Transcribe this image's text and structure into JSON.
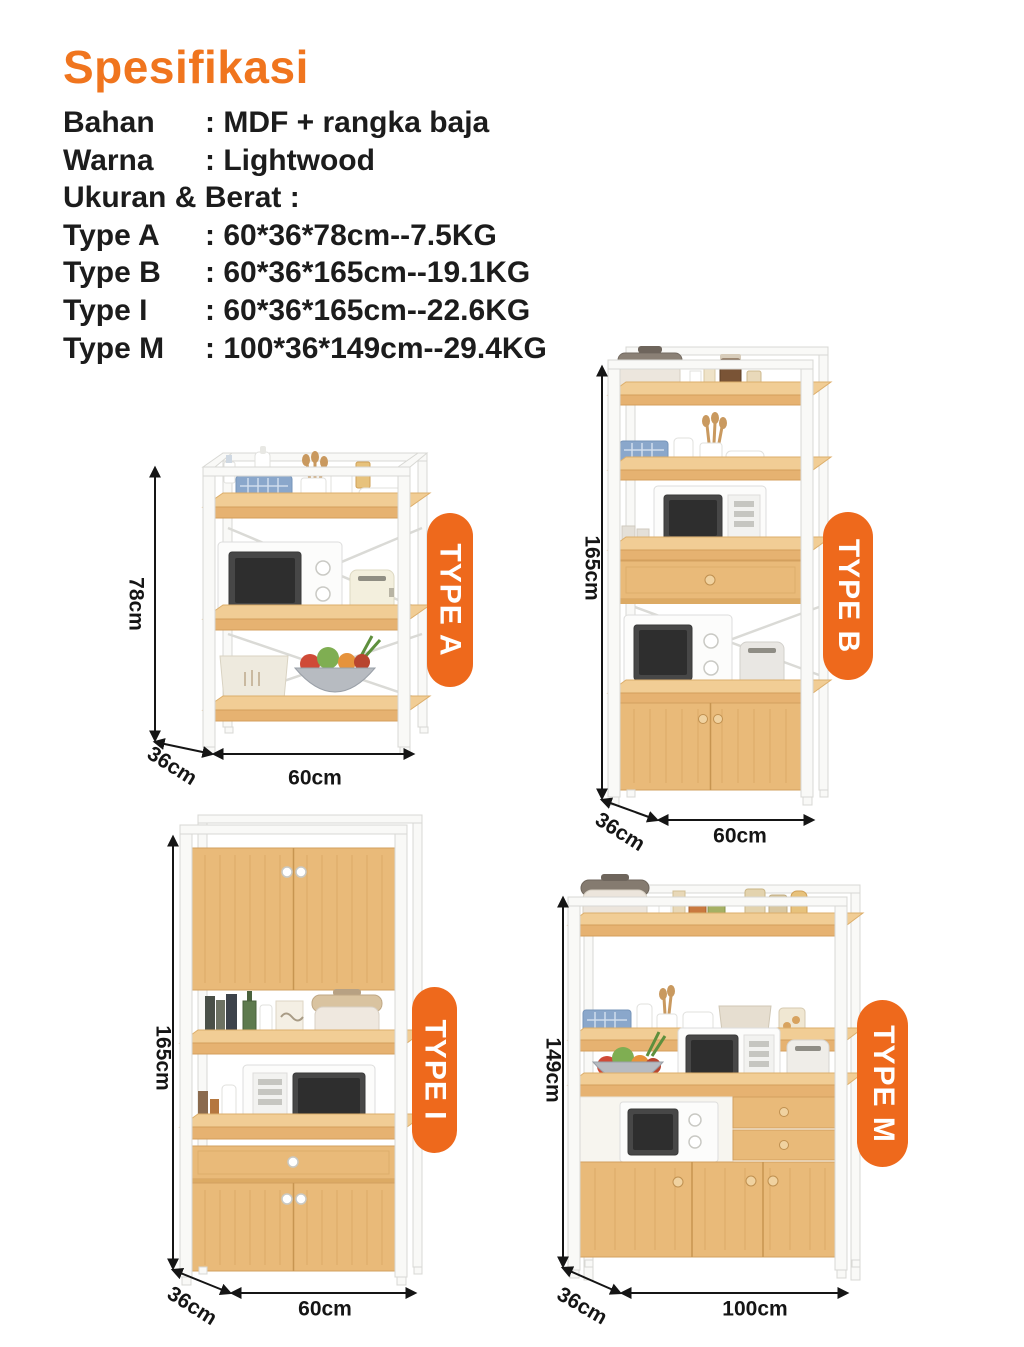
{
  "page": {
    "title": "Spesifikasi"
  },
  "colors": {
    "accent": "#f0751e",
    "badge": "#ee691c",
    "wood": "#e6b271",
    "frame_white": "#f9f9f7",
    "text": "#1c1c1c"
  },
  "specs": {
    "rows": [
      {
        "label": "Bahan",
        "value": ": MDF + rangka baja"
      },
      {
        "label": "Warna",
        "value": ": Lightwood"
      },
      {
        "label": "Ukuran & Berat :",
        "value": ""
      },
      {
        "label": "Type A",
        "value": ": 60*36*78cm--7.5KG"
      },
      {
        "label": "Type B",
        "value": ": 60*36*165cm--19.1KG"
      },
      {
        "label": "Type I",
        "value": ": 60*36*165cm--22.6KG"
      },
      {
        "label": "Type M",
        "value": ": 100*36*149cm--29.4KG"
      }
    ]
  },
  "products": [
    {
      "badge": "TYPE A",
      "height": "78cm",
      "depth": "36cm",
      "width": "60cm"
    },
    {
      "badge": "TYPE B",
      "height": "165cm",
      "depth": "36cm",
      "width": "60cm"
    },
    {
      "badge": "TYPE I",
      "height": "165cm",
      "depth": "36cm",
      "width": "60cm"
    },
    {
      "badge": "TYPE M",
      "height": "149cm",
      "depth": "36cm",
      "width": "100cm"
    }
  ]
}
